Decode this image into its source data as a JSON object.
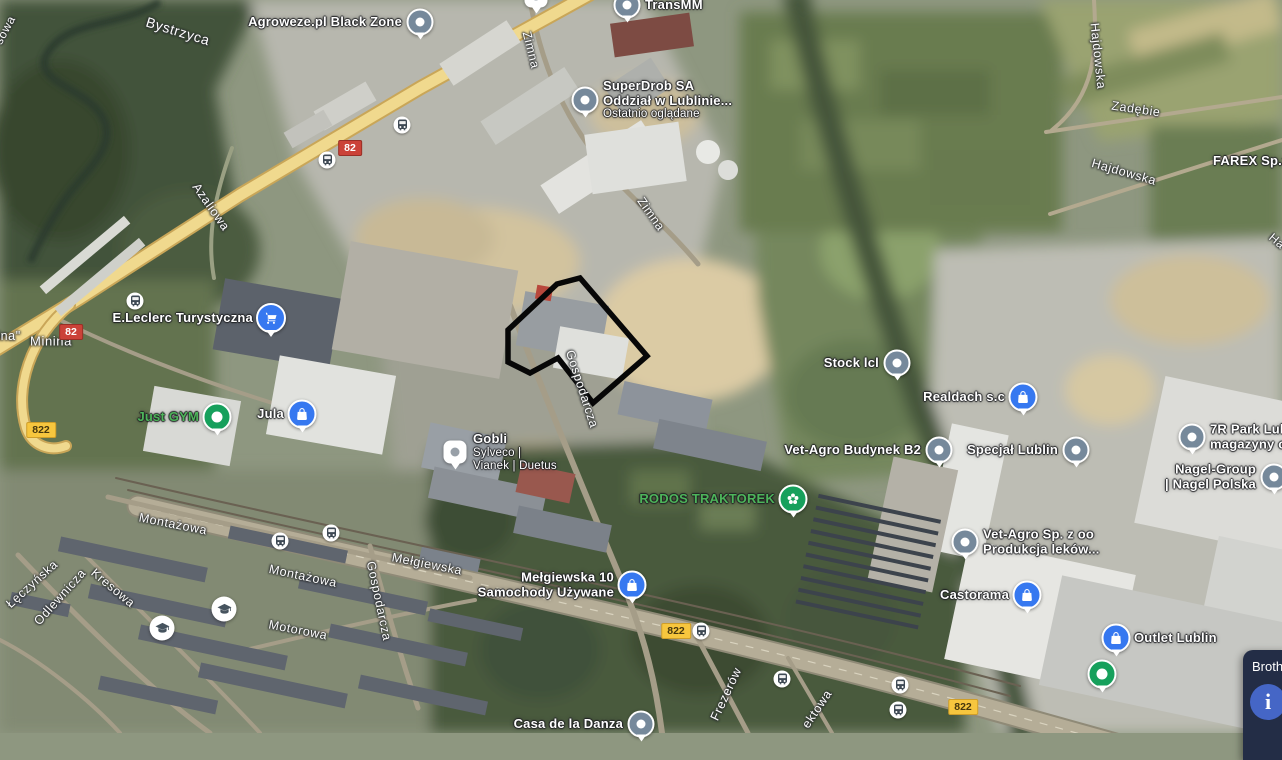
{
  "map_title": "Satellite map - Lublin industrial area",
  "colors": {
    "pin_gray": "#76899b",
    "pin_blue": "#3678f0",
    "pin_green": "#16a05c",
    "poi_green_text": "#4db45a",
    "shield_red": "#cb4238",
    "shield_yellow": "#f7c63e",
    "property_outline": "#070707",
    "info_card_bg": "#232d46"
  },
  "property_outline": {
    "points": "557,284 580,278 647,356 593,403 558,358 530,373 508,362 508,330"
  },
  "pois": [
    {
      "id": "agroweze",
      "lines": [
        "Agroweze.pl Black Zone"
      ],
      "pin": "gray",
      "x": 420,
      "y": 22,
      "side": "left"
    },
    {
      "id": "transmm",
      "lines": [
        "TransMM"
      ],
      "pin": "gray",
      "x": 627,
      "y": 5,
      "side": "right"
    },
    {
      "id": "superdrob",
      "lines": [
        "SuperDrob SA",
        "Oddział w Lublinie..."
      ],
      "sublines": [
        "Ostatnio oglądane"
      ],
      "pin": "gray",
      "x": 585,
      "y": 100,
      "side": "right"
    },
    {
      "id": "eleclerc",
      "lines": [
        "E.Leclerc Turystyczna"
      ],
      "pin": "blue-cart",
      "x": 271,
      "y": 318,
      "side": "left"
    },
    {
      "id": "just-gym",
      "lines": [
        "Just GYM"
      ],
      "pin": "green-dot",
      "x": 217,
      "y": 417,
      "side": "left",
      "color": "green"
    },
    {
      "id": "jula",
      "lines": [
        "Jula"
      ],
      "pin": "blue-bag",
      "x": 302,
      "y": 414,
      "side": "left"
    },
    {
      "id": "gobli",
      "lines": [
        "Gobli"
      ],
      "sublines": [
        "Sylveco |",
        "Vianek | Duetus"
      ],
      "pin": "white-square",
      "x": 455,
      "y": 452,
      "side": "right"
    },
    {
      "id": "rodos-traktorek",
      "lines": [
        "RODOS TRAKTOREK"
      ],
      "pin": "green-flower",
      "x": 793,
      "y": 499,
      "side": "left",
      "color": "green"
    },
    {
      "id": "stock-lcl",
      "lines": [
        "Stock lcl"
      ],
      "pin": "gray",
      "x": 897,
      "y": 363,
      "side": "left"
    },
    {
      "id": "realdach",
      "lines": [
        "Realdach s.c"
      ],
      "pin": "blue-bag",
      "x": 1023,
      "y": 397,
      "side": "left"
    },
    {
      "id": "vet-agro-b2",
      "lines": [
        "Vet-Agro Budynek B2"
      ],
      "pin": "gray",
      "x": 939,
      "y": 450,
      "side": "left"
    },
    {
      "id": "specjal-lublin",
      "lines": [
        "Specjał Lublin"
      ],
      "pin": "gray",
      "x": 1076,
      "y": 450,
      "side": "left"
    },
    {
      "id": "7r-park",
      "lines": [
        "7R Park Lub",
        "magazyny o"
      ],
      "pin": "gray",
      "x": 1192,
      "y": 437,
      "side": "right"
    },
    {
      "id": "nagel-group",
      "lines": [
        "Nagel-Group",
        "| Nagel Polska"
      ],
      "pin": "gray",
      "x": 1274,
      "y": 477,
      "side": "left"
    },
    {
      "id": "vet-agro-sp",
      "lines": [
        "Vet-Agro Sp. z oo",
        "Produkcja leków..."
      ],
      "pin": "gray",
      "x": 965,
      "y": 542,
      "side": "right"
    },
    {
      "id": "castorama",
      "lines": [
        "Castorama"
      ],
      "pin": "blue-bag",
      "x": 1027,
      "y": 595,
      "side": "left"
    },
    {
      "id": "outlet-lublin",
      "lines": [
        "Outlet Lublin"
      ],
      "pin": "blue-bag",
      "x": 1116,
      "y": 638,
      "side": "right"
    },
    {
      "id": "outlet-green-marker",
      "lines": [],
      "pin": "green-dot",
      "x": 1102,
      "y": 674,
      "side": "right"
    },
    {
      "id": "melgiewska-10",
      "lines": [
        "Mełgiewska 10",
        "Samochody Używane"
      ],
      "pin": "blue-bag",
      "x": 632,
      "y": 585,
      "side": "left"
    },
    {
      "id": "casa-de-la-danza",
      "lines": [
        "Casa de la Danza"
      ],
      "pin": "gray",
      "x": 641,
      "y": 724,
      "side": "left"
    },
    {
      "id": "farex",
      "lines": [
        "FAREX Sp.z"
      ],
      "pin": "none",
      "x": 1213,
      "y": 161,
      "side": "right"
    },
    {
      "id": "partial-top-pin",
      "lines": [],
      "pin": "white-square",
      "x": 536,
      "y": -4,
      "side": "right"
    }
  ],
  "street_labels": [
    {
      "text": "Bystrzyca",
      "x": 178,
      "y": 31,
      "rot": 17,
      "size": 14
    },
    {
      "text": "sowa",
      "x": 5,
      "y": 30,
      "rot": -62,
      "size": 12
    },
    {
      "text": "Azaliowa",
      "x": 211,
      "y": 207,
      "rot": 55,
      "size": 12.5
    },
    {
      "text": "ina\"",
      "x": 9,
      "y": 336,
      "rot": 0,
      "size": 12.5
    },
    {
      "text": "Minina",
      "x": 51,
      "y": 341,
      "rot": 0,
      "size": 13
    },
    {
      "text": "Zimna",
      "x": 531,
      "y": 50,
      "rot": 76,
      "size": 12.5
    },
    {
      "text": "Zimna",
      "x": 651,
      "y": 214,
      "rot": 55,
      "size": 12.5
    },
    {
      "text": "Hajdowska",
      "x": 1098,
      "y": 56,
      "rot": 84,
      "size": 12.5
    },
    {
      "text": "Zadębie",
      "x": 1136,
      "y": 109,
      "rot": 8,
      "size": 12.5
    },
    {
      "text": "Hajdowska",
      "x": 1124,
      "y": 172,
      "rot": 16,
      "size": 12.5
    },
    {
      "text": "Ha",
      "x": 1277,
      "y": 241,
      "rot": 40,
      "size": 12
    },
    {
      "text": "Montażowa",
      "x": 173,
      "y": 524,
      "rot": 11,
      "size": 12.5
    },
    {
      "text": "Montażowa",
      "x": 303,
      "y": 576,
      "rot": 12,
      "size": 12.5
    },
    {
      "text": "Mełgiewska",
      "x": 427,
      "y": 564,
      "rot": 11,
      "size": 12.5
    },
    {
      "text": "Motorowa",
      "x": 298,
      "y": 630,
      "rot": 11,
      "size": 12.5
    },
    {
      "text": "Gospodarcza",
      "x": 379,
      "y": 601,
      "rot": 78,
      "size": 12.5
    },
    {
      "text": "Gospodarcza",
      "x": 582,
      "y": 389,
      "rot": 72,
      "size": 12.5
    },
    {
      "text": "Łęczyńska",
      "x": 32,
      "y": 584,
      "rot": -42,
      "size": 12.5
    },
    {
      "text": "Odlewnicza",
      "x": 60,
      "y": 597,
      "rot": -48,
      "size": 12.5
    },
    {
      "text": "Kresowa",
      "x": 113,
      "y": 588,
      "rot": 40,
      "size": 12.5
    },
    {
      "text": "Frezerów",
      "x": 726,
      "y": 694,
      "rot": -65,
      "size": 12.5
    },
    {
      "text": "ektowa",
      "x": 817,
      "y": 709,
      "rot": -56,
      "size": 12.5
    }
  ],
  "road_shields": [
    {
      "label": "82",
      "style": "red",
      "x": 350,
      "y": 148
    },
    {
      "label": "82",
      "style": "red",
      "x": 71,
      "y": 332
    },
    {
      "label": "822",
      "style": "yellow",
      "x": 41,
      "y": 430
    },
    {
      "label": "822",
      "style": "yellow",
      "x": 676,
      "y": 631
    },
    {
      "label": "822",
      "style": "yellow",
      "x": 963,
      "y": 707
    }
  ],
  "bus_stops": [
    {
      "x": 402,
      "y": 125
    },
    {
      "x": 327,
      "y": 160
    },
    {
      "x": 135,
      "y": 301
    },
    {
      "x": 331,
      "y": 533
    },
    {
      "x": 280,
      "y": 541
    },
    {
      "x": 701,
      "y": 631
    },
    {
      "x": 782,
      "y": 679
    },
    {
      "x": 900,
      "y": 685
    },
    {
      "x": 898,
      "y": 710
    }
  ],
  "school_markers": [
    {
      "x": 162,
      "y": 628
    },
    {
      "x": 224,
      "y": 609
    }
  ],
  "info_card": {
    "title": "Brothe",
    "info_icon": "i"
  }
}
